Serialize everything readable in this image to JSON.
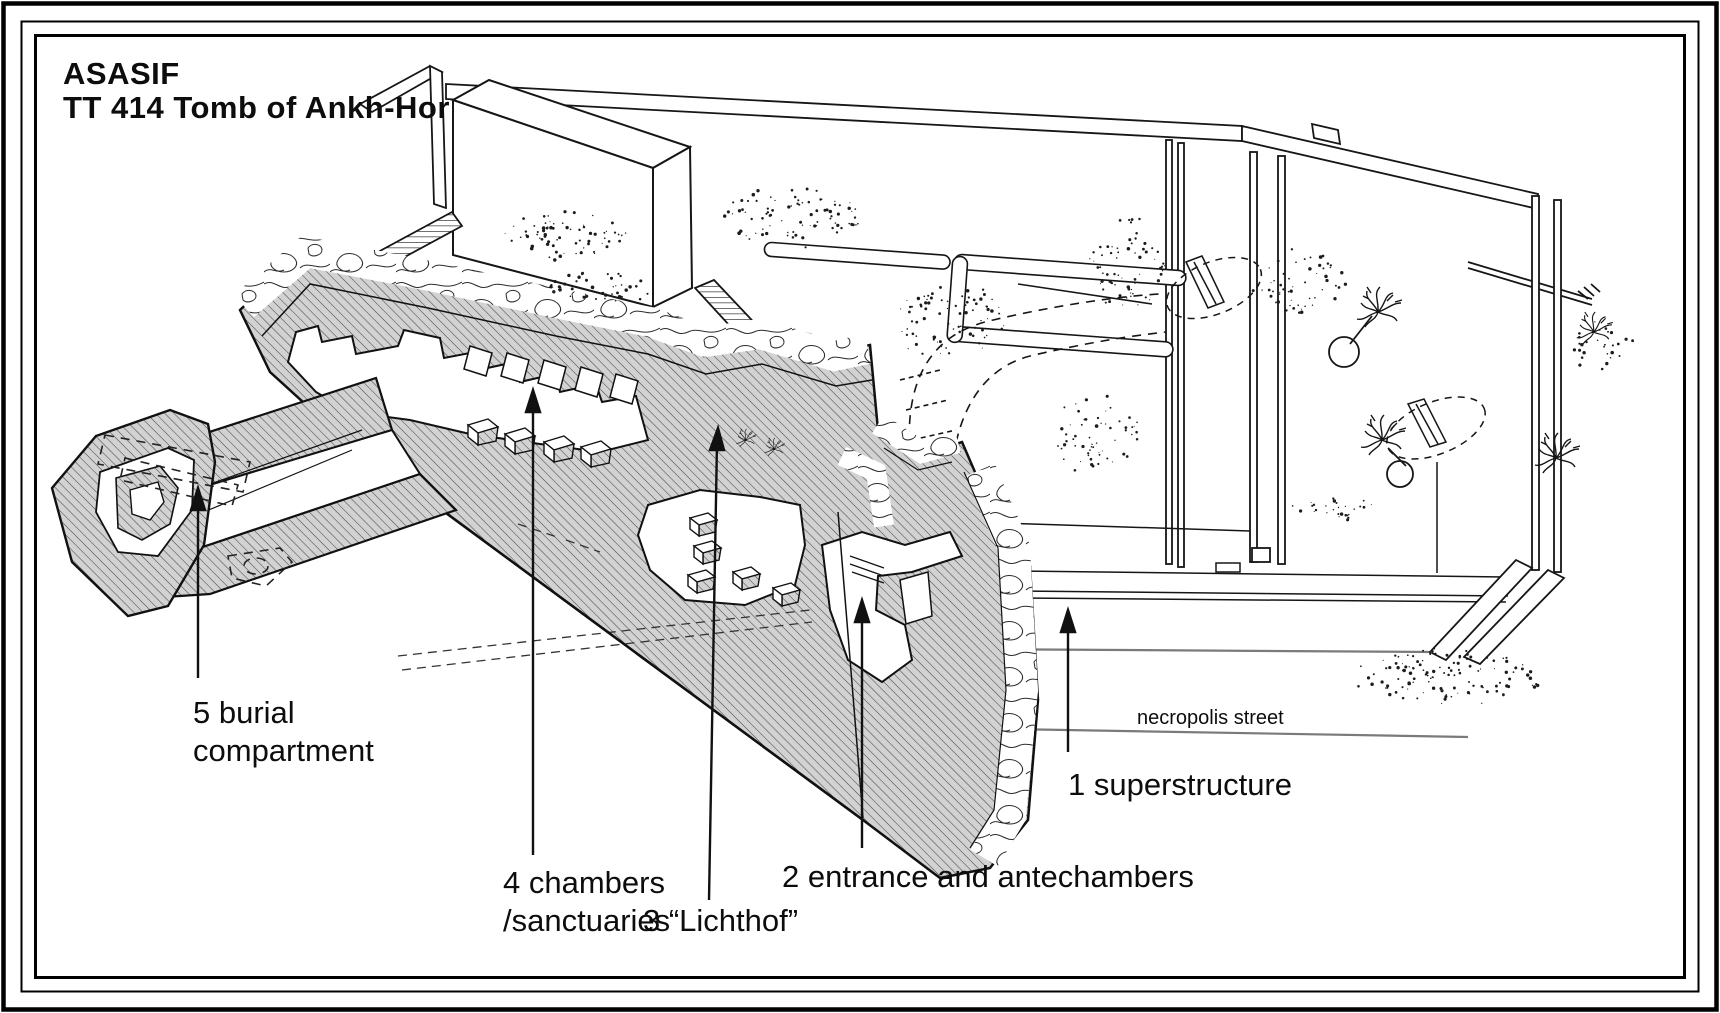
{
  "title": {
    "line1": "ASASIF",
    "line2": "TT 414  Tomb of Ankh-Hor"
  },
  "legend": {
    "burial_compartment": {
      "line1": "5 burial",
      "line2": "compartment"
    },
    "chambers": {
      "line1": "4 chambers",
      "line2": "/sanctuaries"
    },
    "lichthof": {
      "text": "3 “Lichthof”"
    },
    "entrance": {
      "text": "2 entrance and antechambers"
    },
    "superstructure": {
      "text": "1 superstructure"
    },
    "necropolis_street": {
      "text": "necropolis street"
    }
  },
  "diagram": {
    "numbered_parts": [
      {
        "number": "1",
        "label": "superstructure"
      },
      {
        "number": "2",
        "label": "entrance and antechambers"
      },
      {
        "number": "3",
        "label": "“Lichthof”"
      },
      {
        "number": "4",
        "label": "chambers /sanctuaries"
      },
      {
        "number": "5",
        "label": "burial compartment"
      }
    ],
    "street_label": "necropolis street"
  },
  "colors": {
    "ink": "#111111",
    "cut_surface_fill": "#d2d2d2",
    "hatch_line": "#4a4a4a",
    "street_line": "#7a7a7a",
    "paper": "#ffffff"
  }
}
